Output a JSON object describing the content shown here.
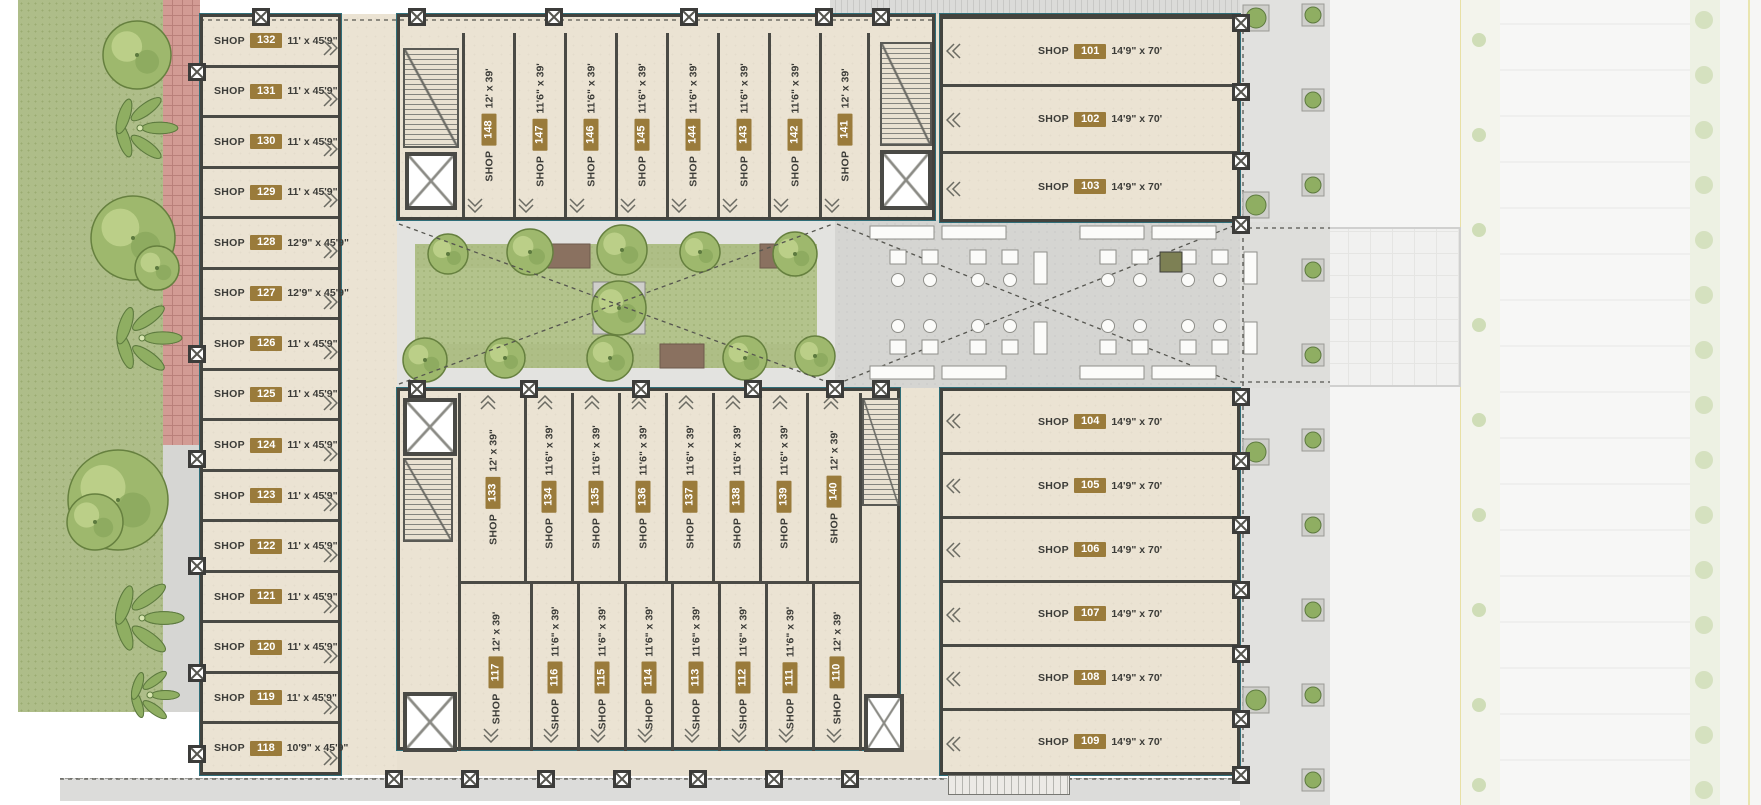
{
  "labels": {
    "shop_prefix": "SHOP"
  },
  "colors": {
    "badge_gold": "#9a7b3b",
    "wall_dark": "#43433e",
    "wall_teal": "#2f6e79",
    "floor_beige": "#ebe3d3",
    "lawn_green": "#aebd89",
    "garden_green": "#b3c38c",
    "brick_red": "#d29b94",
    "concrete_gray": "#d5d5d2"
  },
  "wings": {
    "left": {
      "shops": [
        {
          "num": "132",
          "dim": "11' x 45'9\""
        },
        {
          "num": "131",
          "dim": "11' x 45'9\""
        },
        {
          "num": "130",
          "dim": "11' x 45'9\""
        },
        {
          "num": "129",
          "dim": "11' x 45'9\""
        },
        {
          "num": "128",
          "dim": "12'9\" x 45'9\""
        },
        {
          "num": "127",
          "dim": "12'9\" x 45'9\""
        },
        {
          "num": "126",
          "dim": "11' x 45'9\""
        },
        {
          "num": "125",
          "dim": "11' x 45'9\""
        },
        {
          "num": "124",
          "dim": "11' x 45'9\""
        },
        {
          "num": "123",
          "dim": "11' x 45'9\""
        },
        {
          "num": "122",
          "dim": "11' x 45'9\""
        },
        {
          "num": "121",
          "dim": "11' x 45'9\""
        },
        {
          "num": "120",
          "dim": "11' x 45'9\""
        },
        {
          "num": "119",
          "dim": "11' x 45'9\""
        },
        {
          "num": "118",
          "dim": "10'9\" x 45'9\""
        }
      ]
    },
    "top": {
      "shops": [
        {
          "num": "148",
          "dim": "12' x 39'"
        },
        {
          "num": "147",
          "dim": "11'6\" x 39'"
        },
        {
          "num": "146",
          "dim": "11'6\" x 39'"
        },
        {
          "num": "145",
          "dim": "11'6\" x 39'"
        },
        {
          "num": "144",
          "dim": "11'6\" x 39'"
        },
        {
          "num": "143",
          "dim": "11'6\" x 39'"
        },
        {
          "num": "142",
          "dim": "11'6\" x 39'"
        },
        {
          "num": "141",
          "dim": "12' x 39'"
        }
      ]
    },
    "bottom_upper": {
      "shops": [
        {
          "num": "133",
          "dim": "12' x 39\""
        },
        {
          "num": "134",
          "dim": "11'6\" x 39'"
        },
        {
          "num": "135",
          "dim": "11'6\" x 39'"
        },
        {
          "num": "136",
          "dim": "11'6\" x 39'"
        },
        {
          "num": "137",
          "dim": "11'6\" x 39'"
        },
        {
          "num": "138",
          "dim": "11'6\" x 39'"
        },
        {
          "num": "139",
          "dim": "11'6\" x 39'"
        },
        {
          "num": "140",
          "dim": "12' x 39'"
        }
      ]
    },
    "bottom_lower": {
      "shops": [
        {
          "num": "117",
          "dim": "12' x 39'"
        },
        {
          "num": "116",
          "dim": "11'6\" x 39'"
        },
        {
          "num": "115",
          "dim": "11'6\" x 39'"
        },
        {
          "num": "114",
          "dim": "11'6\" x 39'"
        },
        {
          "num": "113",
          "dim": "11'6\" x 39'"
        },
        {
          "num": "112",
          "dim": "11'6\" x 39'"
        },
        {
          "num": "111",
          "dim": "11'6\" x 39'"
        },
        {
          "num": "110",
          "dim": "12' x 39'"
        }
      ]
    },
    "right_top": {
      "shops": [
        {
          "num": "101",
          "dim": "14'9\" x 70'"
        },
        {
          "num": "102",
          "dim": "14'9\" x 70'"
        },
        {
          "num": "103",
          "dim": "14'9\" x 70'"
        }
      ]
    },
    "right_bottom": {
      "shops": [
        {
          "num": "104",
          "dim": "14'9\" x 70'"
        },
        {
          "num": "105",
          "dim": "14'9\" x 70'"
        },
        {
          "num": "106",
          "dim": "14'9\" x 70'"
        },
        {
          "num": "107",
          "dim": "14'9\" x 70'"
        },
        {
          "num": "108",
          "dim": "14'9\" x 70'"
        },
        {
          "num": "109",
          "dim": "14'9\" x 70'"
        }
      ]
    }
  }
}
